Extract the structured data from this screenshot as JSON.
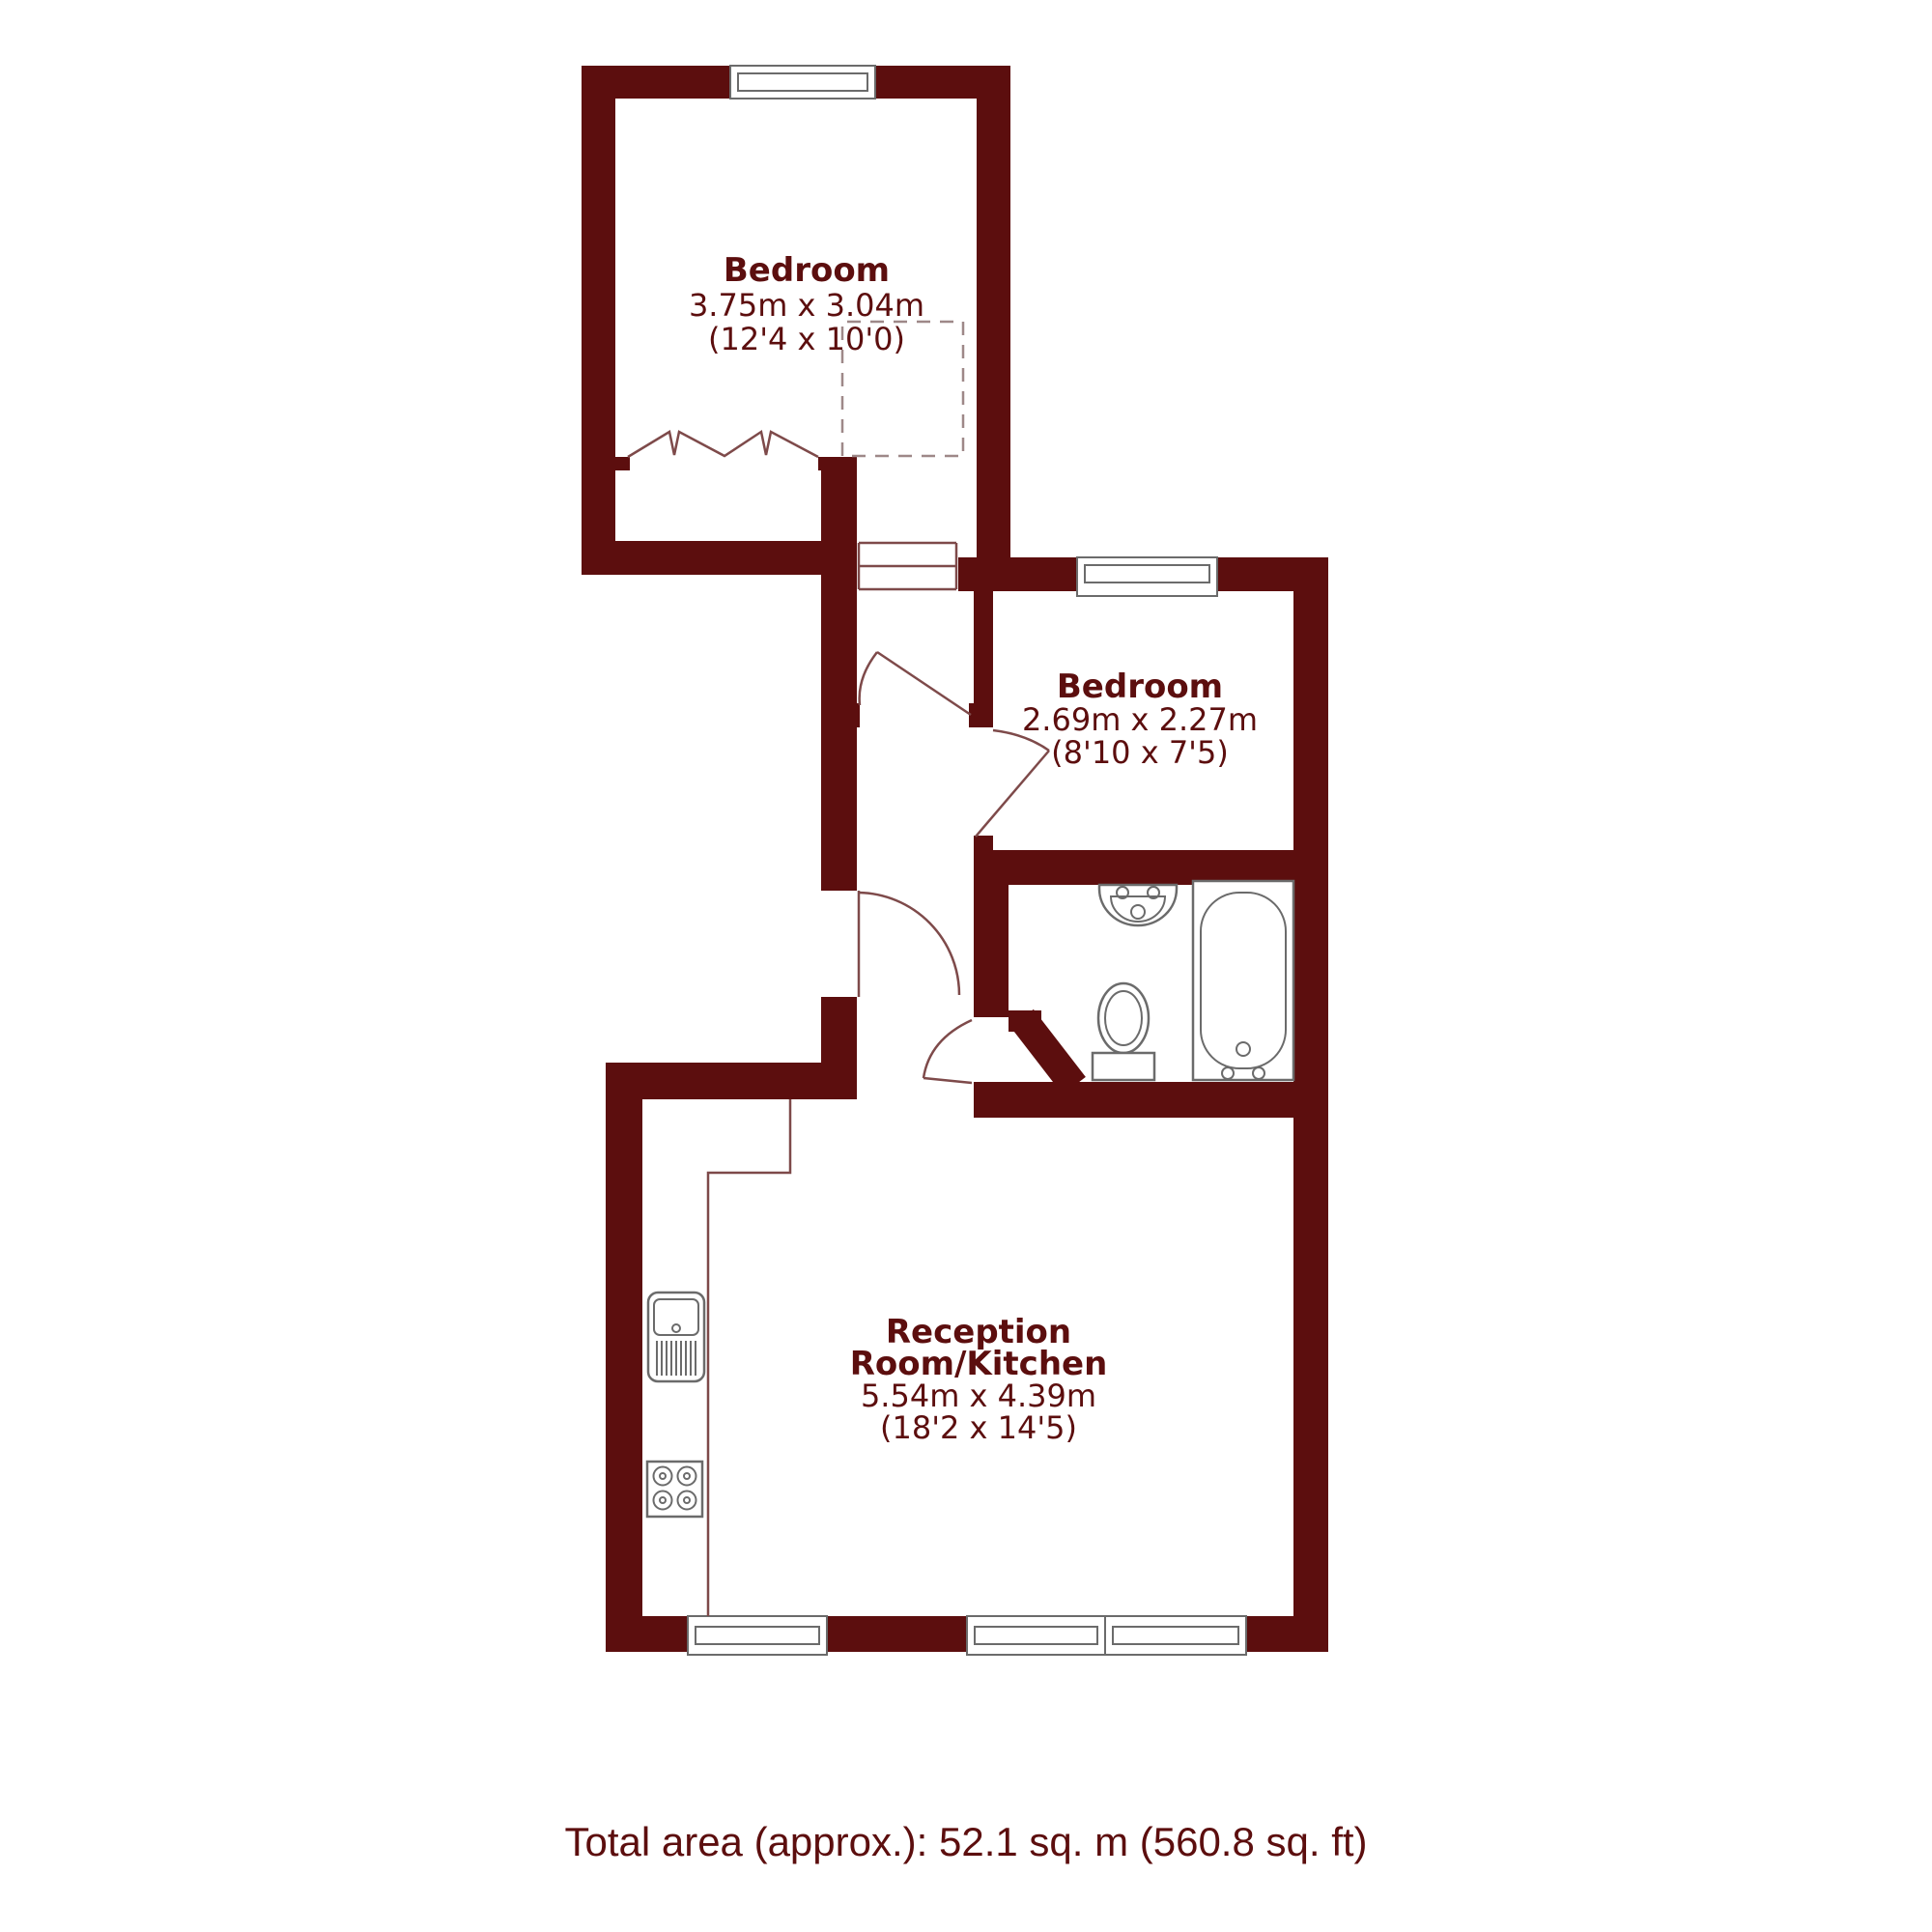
{
  "plan": {
    "rooms": [
      {
        "name": "Bedroom",
        "metric": "3.75m x 3.04m",
        "imperial": "(12'4 x 10'0)"
      },
      {
        "name": "Bedroom",
        "metric": "2.69m x 2.27m",
        "imperial": "(8'10 x 7'5)"
      },
      {
        "name_line1": "Reception",
        "name_line2": "Room/Kitchen",
        "metric": "5.54m x 4.39m",
        "imperial": "(18'2 x 14'5)"
      }
    ],
    "fixtures": {
      "bathroom": [
        "wash-basin",
        "toilet",
        "bathtub"
      ],
      "kitchen": [
        "sink-with-drainer",
        "hob",
        "worktop"
      ],
      "bedroom_1": [
        "bifold-closet",
        "dashed-wardrobe"
      ]
    },
    "windows_count": 5,
    "footer": {
      "total_area": "Total area (approx.): 52.1 sq. m (560.8 sq. ft)"
    },
    "colors": {
      "wall": "#5c0e0e",
      "door_line": "#7e4a4a",
      "fixture_line": "#6b6b6b",
      "dash_line": "#9e8888",
      "text": "#5c0e0e",
      "background": "#ffffff"
    }
  }
}
